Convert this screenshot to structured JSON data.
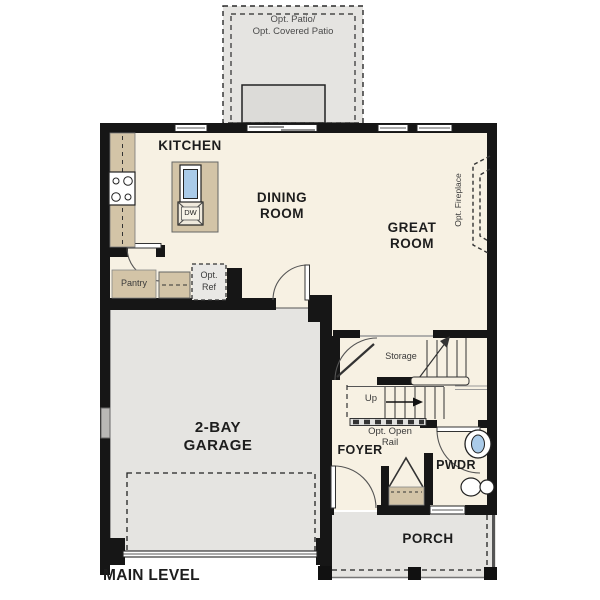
{
  "plan": {
    "level_label": "MAIN LEVEL",
    "rooms": {
      "patio": {
        "line1": "Opt. Patio/",
        "line2": "Opt. Covered Patio"
      },
      "kitchen": {
        "label": "KITCHEN",
        "dishwasher": "DW",
        "pantry": "Pantry",
        "opt_ref_line1": "Opt.",
        "opt_ref_line2": "Ref"
      },
      "dining": {
        "line1": "DINING",
        "line2": "ROOM"
      },
      "great": {
        "line1": "GREAT",
        "line2": "ROOM",
        "fireplace": "Opt. Fireplace"
      },
      "garage": {
        "line1": "2-BAY",
        "line2": "GARAGE"
      },
      "stairs": {
        "storage": "Storage",
        "up": "Up",
        "rail_line1": "Opt. Open",
        "rail_line2": "Rail"
      },
      "foyer": {
        "label": "FOYER"
      },
      "pwdr": {
        "label": "PWDR"
      },
      "porch": {
        "label": "PORCH"
      }
    },
    "colors": {
      "floor": "#f7f1e3",
      "exterior_gray": "#e5e4e1",
      "cabinet_tan": "#d3c4a7",
      "wall": "#161616",
      "sink_blue": "#aacbe9"
    }
  }
}
